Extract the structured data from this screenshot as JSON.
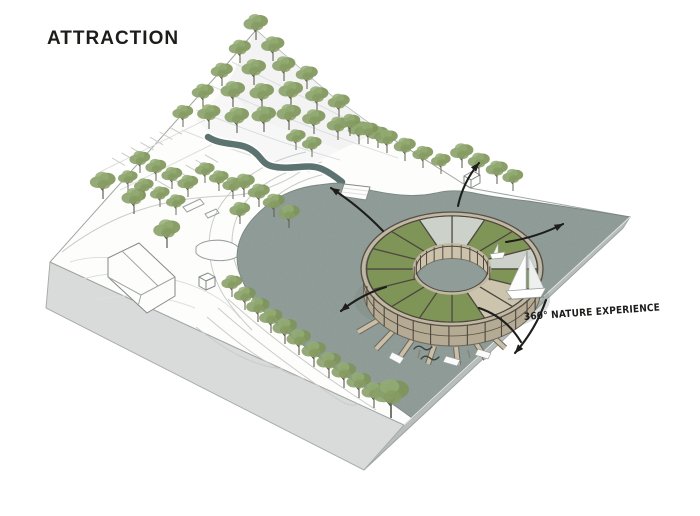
{
  "title": "ATTRACTION",
  "annotation": {
    "label": "360° NATURE EXPERIENCE"
  },
  "colors": {
    "ink": "#1d1d1b",
    "water": "#919e99",
    "waterEdge": "#7b8783",
    "cliffLight": "#d9dbda",
    "cliffDark": "#b9bebc",
    "line": "#9aa09e",
    "roofGreen": "#7e9557",
    "glassPanel": "#ccd1c9",
    "deckTan": "#cdc4ae",
    "fasciaTan": "#c2b8a1",
    "wallTan": "#b5aa93",
    "frame": "#4d473f",
    "pierTan": "#c9bfa8",
    "trunk": "#5c5c50",
    "foliage": "#7d9458"
  },
  "scene": {
    "trees": [
      [
        256,
        40,
        1.0
      ],
      [
        240,
        63,
        0.9
      ],
      [
        273,
        61,
        0.95
      ],
      [
        222,
        86,
        0.9
      ],
      [
        254,
        85,
        1.0
      ],
      [
        284,
        81,
        0.95
      ],
      [
        307,
        89,
        0.9
      ],
      [
        203,
        107,
        0.9
      ],
      [
        233,
        107,
        1.0
      ],
      [
        262,
        109,
        1.0
      ],
      [
        291,
        107,
        1.0
      ],
      [
        317,
        111,
        0.95
      ],
      [
        339,
        117,
        0.9
      ],
      [
        183,
        127,
        0.85
      ],
      [
        209,
        129,
        0.95
      ],
      [
        237,
        133,
        1.0
      ],
      [
        264,
        132,
        1.0
      ],
      [
        289,
        130,
        1.0
      ],
      [
        314,
        134,
        0.95
      ],
      [
        338,
        140,
        0.9
      ],
      [
        359,
        144,
        0.9
      ],
      [
        378,
        148,
        0.85
      ],
      [
        350,
        136,
        0.85
      ],
      [
        368,
        144,
        0.85
      ],
      [
        387,
        153,
        0.9
      ],
      [
        405,
        161,
        0.9
      ],
      [
        423,
        168,
        0.85
      ],
      [
        441,
        174,
        0.8
      ],
      [
        462,
        168,
        0.95
      ],
      [
        479,
        176,
        0.9
      ],
      [
        497,
        184,
        0.9
      ],
      [
        513,
        191,
        0.85
      ],
      [
        296,
        150,
        0.8
      ],
      [
        312,
        157,
        0.8
      ],
      [
        140,
        173,
        0.85
      ],
      [
        156,
        181,
        0.85
      ],
      [
        172,
        189,
        0.85
      ],
      [
        188,
        197,
        0.85
      ],
      [
        128,
        191,
        0.8
      ],
      [
        144,
        199,
        0.8
      ],
      [
        160,
        207,
        0.8
      ],
      [
        176,
        215,
        0.8
      ],
      [
        205,
        183,
        0.8
      ],
      [
        219,
        191,
        0.8
      ],
      [
        233,
        199,
        0.85
      ],
      [
        103,
        199,
        1.05
      ],
      [
        134,
        214,
        1.0
      ],
      [
        167,
        248,
        1.1
      ],
      [
        244,
        197,
        0.9
      ],
      [
        259,
        207,
        0.9
      ],
      [
        274,
        217,
        0.9
      ],
      [
        289,
        228,
        0.9
      ],
      [
        240,
        224,
        0.85
      ],
      [
        232,
        297,
        0.85
      ],
      [
        245,
        310,
        0.9
      ],
      [
        258,
        322,
        0.95
      ],
      [
        271,
        333,
        0.95
      ],
      [
        285,
        344,
        1.0
      ],
      [
        299,
        355,
        1.0
      ],
      [
        314,
        367,
        1.0
      ],
      [
        329,
        378,
        1.0
      ],
      [
        344,
        388,
        1.0
      ],
      [
        359,
        398,
        1.0
      ],
      [
        374,
        408,
        1.0
      ],
      [
        391,
        418,
        1.5
      ]
    ],
    "ring": {
      "center": [
        452,
        269
      ],
      "outer": [
        85.5,
        53.2
      ],
      "inner": [
        38,
        24.5
      ],
      "wall_height": 22,
      "segments": [
        "glass",
        "green",
        "green",
        "glass",
        "green",
        "tan",
        "tan",
        "green",
        "green",
        "green",
        "green",
        "green",
        "green",
        "green",
        "green",
        "glass"
      ]
    },
    "arrows": [
      {
        "x1": 383,
        "y1": 231,
        "x2": 331,
        "y2": 188,
        "bend": 4,
        "head": true
      },
      {
        "x1": 458,
        "y1": 206,
        "x2": 479,
        "y2": 163,
        "bend": -6,
        "head": true
      },
      {
        "x1": 506,
        "y1": 242,
        "x2": 563,
        "y2": 224,
        "bend": 5,
        "head": true
      },
      {
        "x1": 386,
        "y1": 287,
        "x2": 341,
        "y2": 311,
        "bend": 5,
        "head": true
      },
      {
        "x1": 479,
        "y1": 308,
        "x2": 521,
        "y2": 342,
        "bend": -10,
        "head": false
      },
      {
        "x1": 546,
        "y1": 300,
        "x2": 515,
        "y2": 353,
        "bend": -6,
        "head": true
      }
    ]
  }
}
